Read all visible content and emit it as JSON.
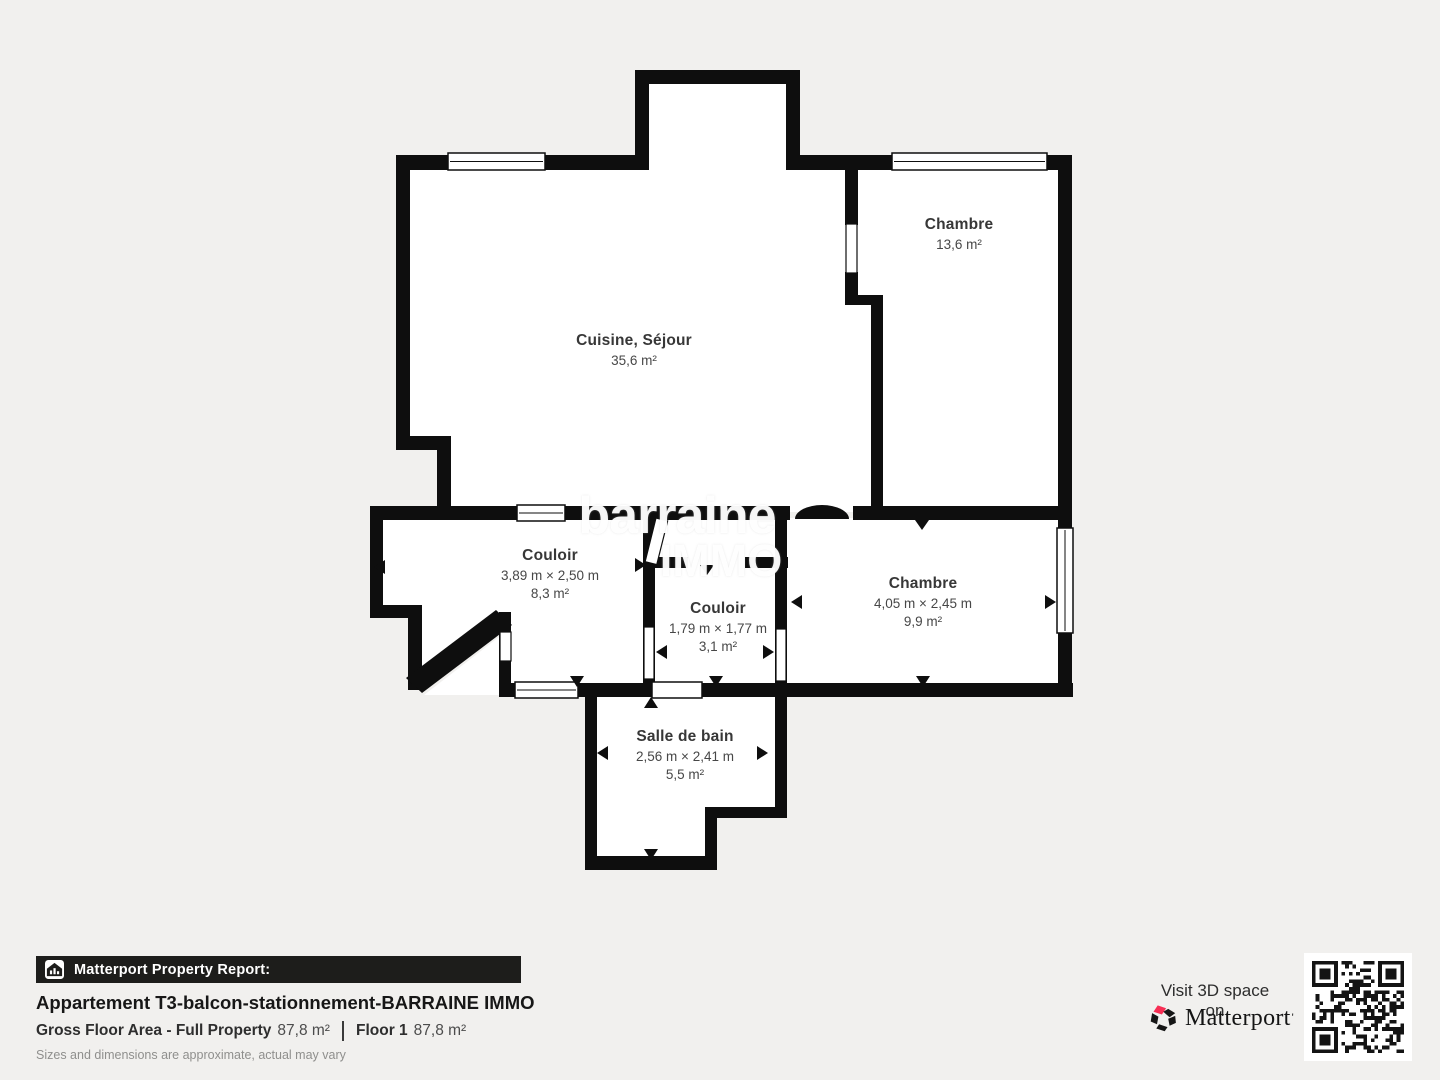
{
  "floorplan": {
    "watermark": {
      "line1": "barraine",
      "line2": "IMMO"
    },
    "rooms": [
      {
        "name": "Cuisine, Séjour",
        "dims": "",
        "area": "35,6 m²"
      },
      {
        "name": "Chambre",
        "dims": "",
        "area": "13,6 m²"
      },
      {
        "name": "Couloir",
        "dims": "3,89 m × 2,50 m",
        "area": "8,3 m²"
      },
      {
        "name": "Couloir",
        "dims": "1,79 m × 1,77 m",
        "area": "3,1 m²"
      },
      {
        "name": "Chambre",
        "dims": "4,05 m × 2,45 m",
        "area": "9,9 m²"
      },
      {
        "name": "Salle de bain",
        "dims": "2,56 m × 2,41 m",
        "area": "5,5 m²"
      }
    ],
    "wall_color": "#0e0e0e",
    "floor_color": "#ffffff"
  },
  "report": {
    "bar_label": "Matterport Property Report:",
    "title": "Appartement T3-balcon-stationnement-BARRAINE IMMO",
    "gross_label": "Gross Floor Area - Full Property",
    "gross_value": "87,8 m²",
    "floor_label": "Floor 1",
    "floor_value": "87,8 m²",
    "disclaimer": "Sizes and dimensions are approximate, actual may vary"
  },
  "cta": {
    "visit_text": "Visit 3D space on",
    "brand": "Matterport",
    "brand_color": "#f72e54"
  }
}
